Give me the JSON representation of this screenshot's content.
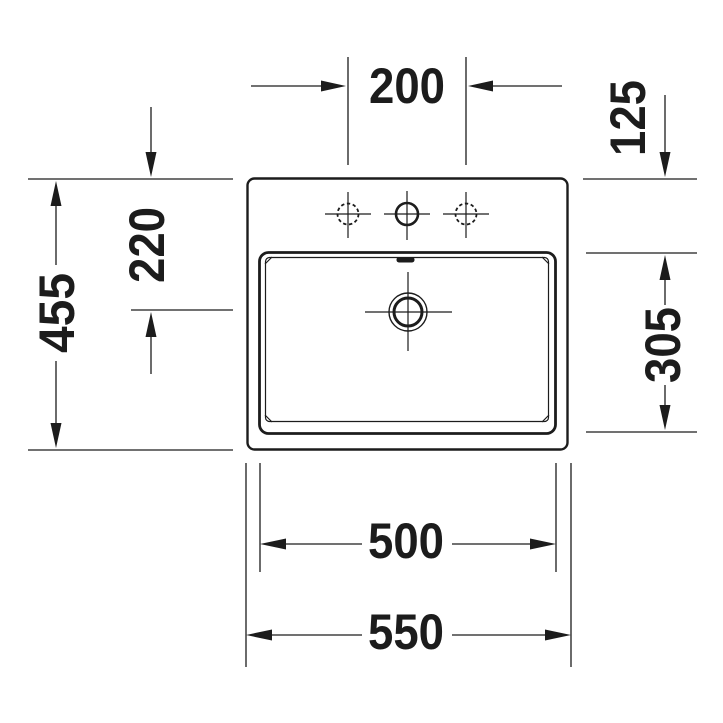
{
  "drawing": {
    "kind": "washbasin-plan-view-dimension-drawing",
    "colors": {
      "line": "#1c1c1c",
      "background": "#ffffff"
    },
    "dimensions": {
      "tap_hole_spacing": "200",
      "rear_edge_to_basin": "125",
      "overall_depth": "455",
      "rear_edge_to_drain": "220",
      "basin_depth": "305",
      "basin_width": "500",
      "overall_width": "550"
    },
    "features": {
      "tap_holes": "3",
      "drain": "concentric-circles",
      "overflow": "rear-center-slot"
    }
  }
}
